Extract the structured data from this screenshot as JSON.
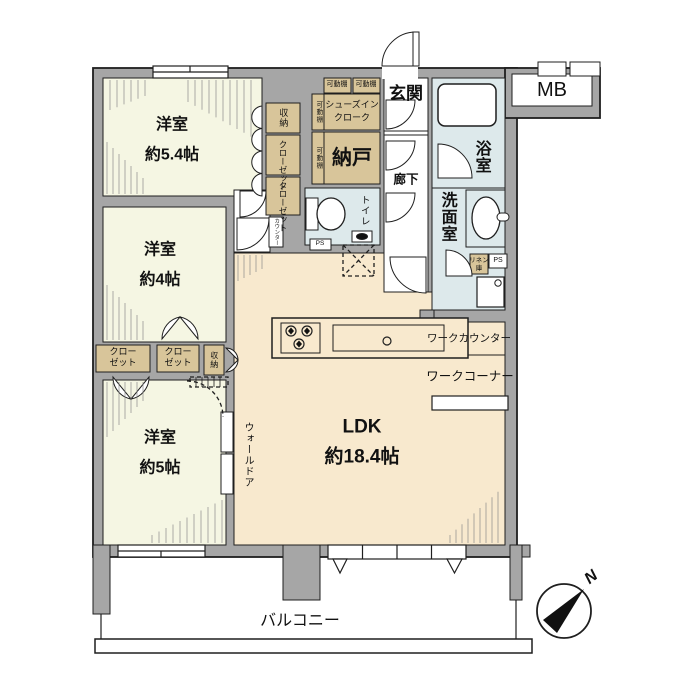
{
  "meta": {
    "type": "floor-plan"
  },
  "colors": {
    "wall": "#a6a6a6",
    "bedroom": "#f5f6e3",
    "ldk": "#f8e9ce",
    "storage": "#d8c59a",
    "wet": "#dde9eb",
    "line": "#1f1f1f",
    "white": "#ffffff"
  },
  "rooms": {
    "bedroom54": {
      "name": "洋室",
      "size": "約5.4帖"
    },
    "bedroom4": {
      "name": "洋室",
      "size": "約4帖"
    },
    "bedroom5": {
      "name": "洋室",
      "size": "約5帖"
    },
    "ldk": {
      "name": "LDK",
      "size": "約18.4帖"
    },
    "nando": {
      "name": "納戸"
    },
    "sic": {
      "line1": "シューズイン",
      "line2": "クローク"
    },
    "genkan": {
      "name": "玄関"
    },
    "rouka": {
      "name": "廊下"
    },
    "bathroom": {
      "name": "浴室"
    },
    "washroom": {
      "name": "洗面室"
    },
    "toilet": {
      "name": "トイレ"
    },
    "balcony": {
      "name": "バルコニー"
    }
  },
  "storage": {
    "shelf": "可動棚",
    "shuno": "収納",
    "closet": "クローゼット",
    "closet_line1": "クロー",
    "closet_line2": "ゼット",
    "linen_line1": "リネン",
    "linen_line2": "庫",
    "counter": "カウンター"
  },
  "features": {
    "mb": "MB",
    "ps": "PS",
    "work_counter": "ワークカウンター",
    "work_corner": "ワークコーナー",
    "wall_door": "ウォールドア",
    "north": "N"
  }
}
